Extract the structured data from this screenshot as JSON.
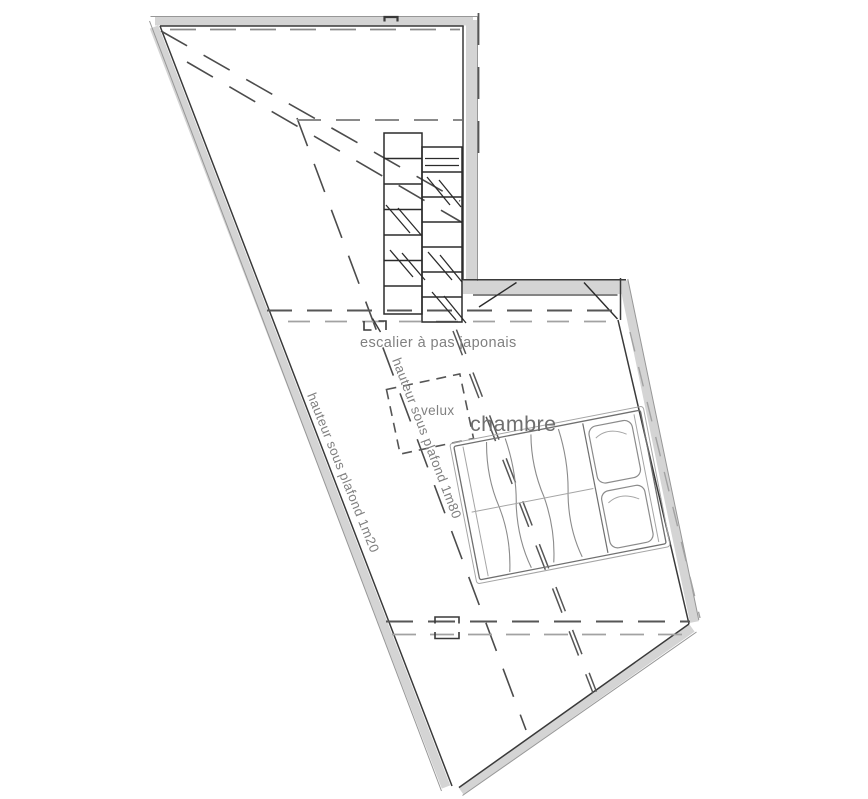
{
  "plan": {
    "labels": {
      "staircase": "escalier à pas japonais",
      "skylight": "velux",
      "bedroom": "chambre",
      "ceiling_low": "hauteur sous plafond 1m20",
      "ceiling_mid": "hauteur sous plafond 1m80"
    },
    "colors": {
      "bg": "#ffffff",
      "wall_fill": "#d4d4d4",
      "edge_dark": "#3a3a3a",
      "edge_light": "#979797",
      "stair": "#2b2b2b",
      "dash_dark": "#4c4c4c",
      "dash_mid": "#565656",
      "dash_gray": "#8a8a8a",
      "dash_light": "#a2a2a2",
      "furn": "#8b8b8b",
      "furn_light": "#a5a5a5",
      "furn_dark": "#6f6f6f",
      "text": "#808080",
      "text_room": "#6f6f6f"
    }
  }
}
